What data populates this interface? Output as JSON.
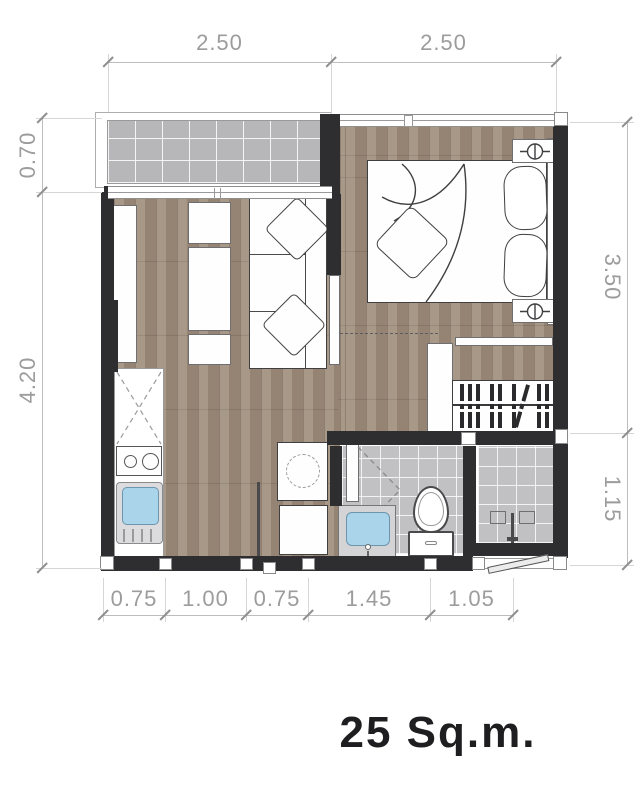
{
  "title": "25 Sq.m.",
  "dimensions": {
    "top": [
      "2.50",
      "2.50"
    ],
    "left": [
      "0.70",
      "4.20"
    ],
    "right": [
      "3.50",
      "1.15"
    ],
    "bottom": [
      "0.75",
      "1.00",
      "0.75",
      "1.45",
      "1.05"
    ]
  },
  "colors": {
    "wall": "#2e2e30",
    "wood_floor": "#9e8c7a",
    "balcony_tile": "#b7b7b9",
    "bathroom_tile": "#c1c1c4",
    "sink_blue": "#a9d4e9",
    "dimension_text": "#9c9c9c",
    "title_text": "#1e1e20"
  },
  "elements": {
    "rooms": [
      "balcony",
      "living-area",
      "bedroom",
      "kitchen",
      "corridor",
      "bathroom",
      "shower"
    ],
    "furniture": [
      "bed",
      "pillows",
      "blanket",
      "throw-cushion",
      "nightstand-lamps",
      "sofa",
      "tv-console",
      "closet",
      "wardrobe-hanger-rail",
      "kitchen-counter",
      "stove",
      "kitchen-sink",
      "side-table",
      "toilet",
      "bathroom-sink",
      "shower-fixture",
      "bathroom-door",
      "bedroom-door",
      "entry-door"
    ]
  }
}
